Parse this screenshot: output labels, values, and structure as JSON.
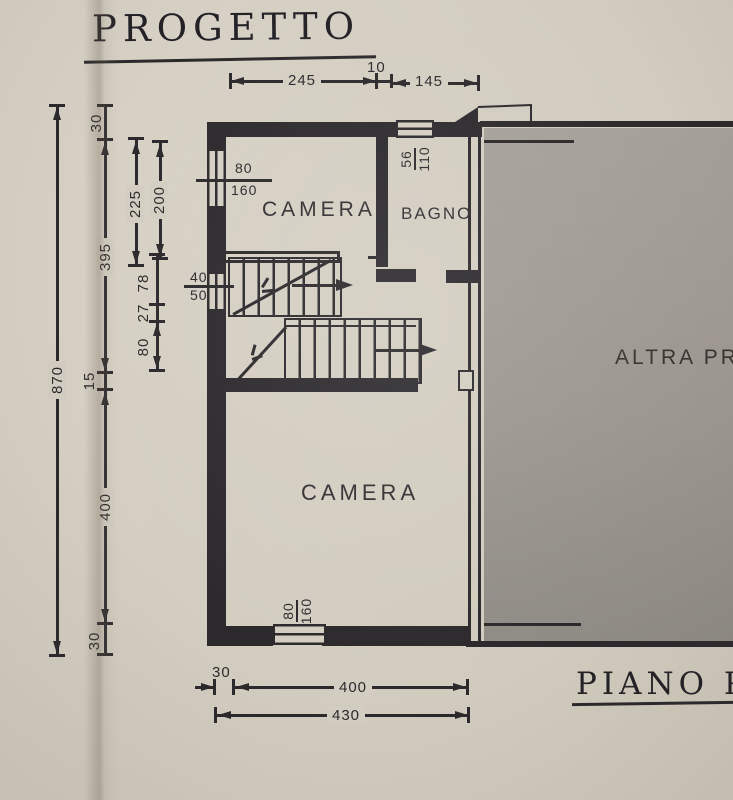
{
  "title": {
    "main": "PROGETTO",
    "bottom": "PIANO P"
  },
  "labels": {
    "camera_upper": "CAMERA",
    "bagno": "BAGNO",
    "camera_lower": "CAMERA",
    "neighbor": "ALTRA PR"
  },
  "windows": {
    "left_upper": {
      "w": "80",
      "h": "160"
    },
    "top": {
      "w": "56",
      "h": "110"
    },
    "left_lower": {
      "w": "40",
      "h": "50"
    },
    "bottom": {
      "w": "80",
      "h": "160"
    }
  },
  "dims": {
    "top_a": "245",
    "top_b": "10",
    "top_c": "145",
    "left_total": "870",
    "left_wall_top": "30",
    "left_upper": "395",
    "left_wall_mid": "15",
    "left_lower": "400",
    "left_wall_bottom": "30",
    "left_room_a": "225",
    "left_room_b": "200",
    "left_stair_a": "78",
    "left_stair_b": "27",
    "left_stair_c": "80",
    "bottom_a": "30",
    "bottom_b": "400",
    "bottom_c": "430"
  },
  "colors": {
    "paper": "#d4cec2",
    "ink": "#2b292c",
    "neighbor": "#a5a098"
  }
}
